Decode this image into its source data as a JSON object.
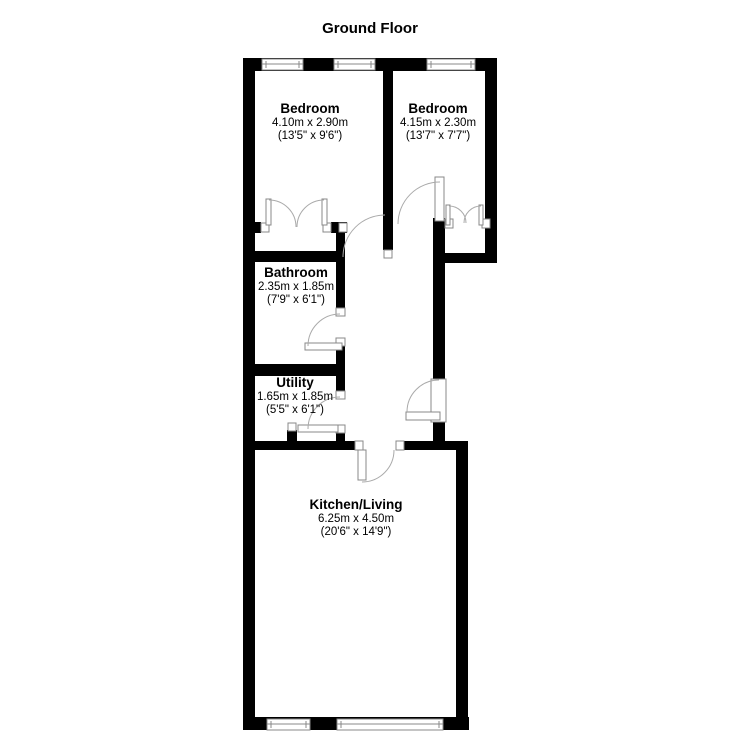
{
  "title": "Ground Floor",
  "rooms": [
    {
      "name": "Bedroom",
      "metric": "4.10m x 2.90m",
      "imperial": "(13'5\" x 9'6\")"
    },
    {
      "name": "Bedroom",
      "metric": "4.15m x 2.30m",
      "imperial": "(13'7\" x 7'7\")"
    },
    {
      "name": "Bathroom",
      "metric": "2.35m x 1.85m",
      "imperial": "(7'9\" x 6'1\")"
    },
    {
      "name": "Utility",
      "metric": "1.65m x 1.85m",
      "imperial": "(5'5\" x 6'1\")"
    },
    {
      "name": "Kitchen/Living",
      "metric": "6.25m x 4.50m",
      "imperial": "(20'6\" x 14'9\")"
    }
  ],
  "colors": {
    "wall": "#000000",
    "background": "#ffffff",
    "door_line": "#aaaaaa",
    "frame_line": "#888888",
    "text": "#000000"
  }
}
